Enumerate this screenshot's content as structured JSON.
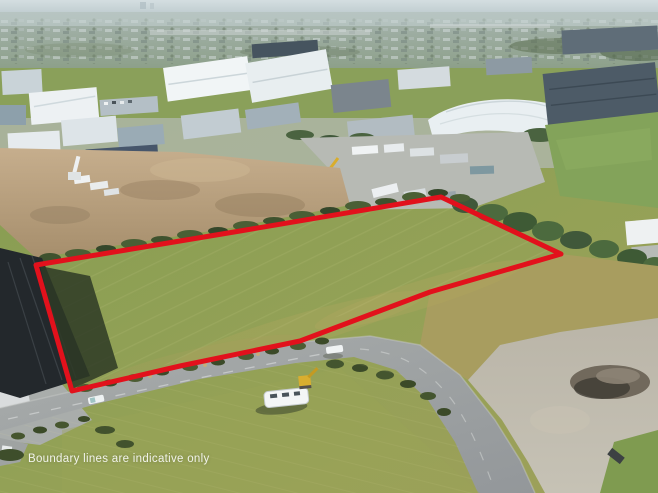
{
  "watermark": {
    "text": "Boundary lines are indicative only"
  },
  "theme": {
    "boundary-red": "#e2111c",
    "watermark-color": "rgba(255,255,255,0.88)"
  },
  "boundary": {
    "points": "36,265 240,231 441,197 561,254 430,292 300,341 180,366 72,391 54,328"
  }
}
